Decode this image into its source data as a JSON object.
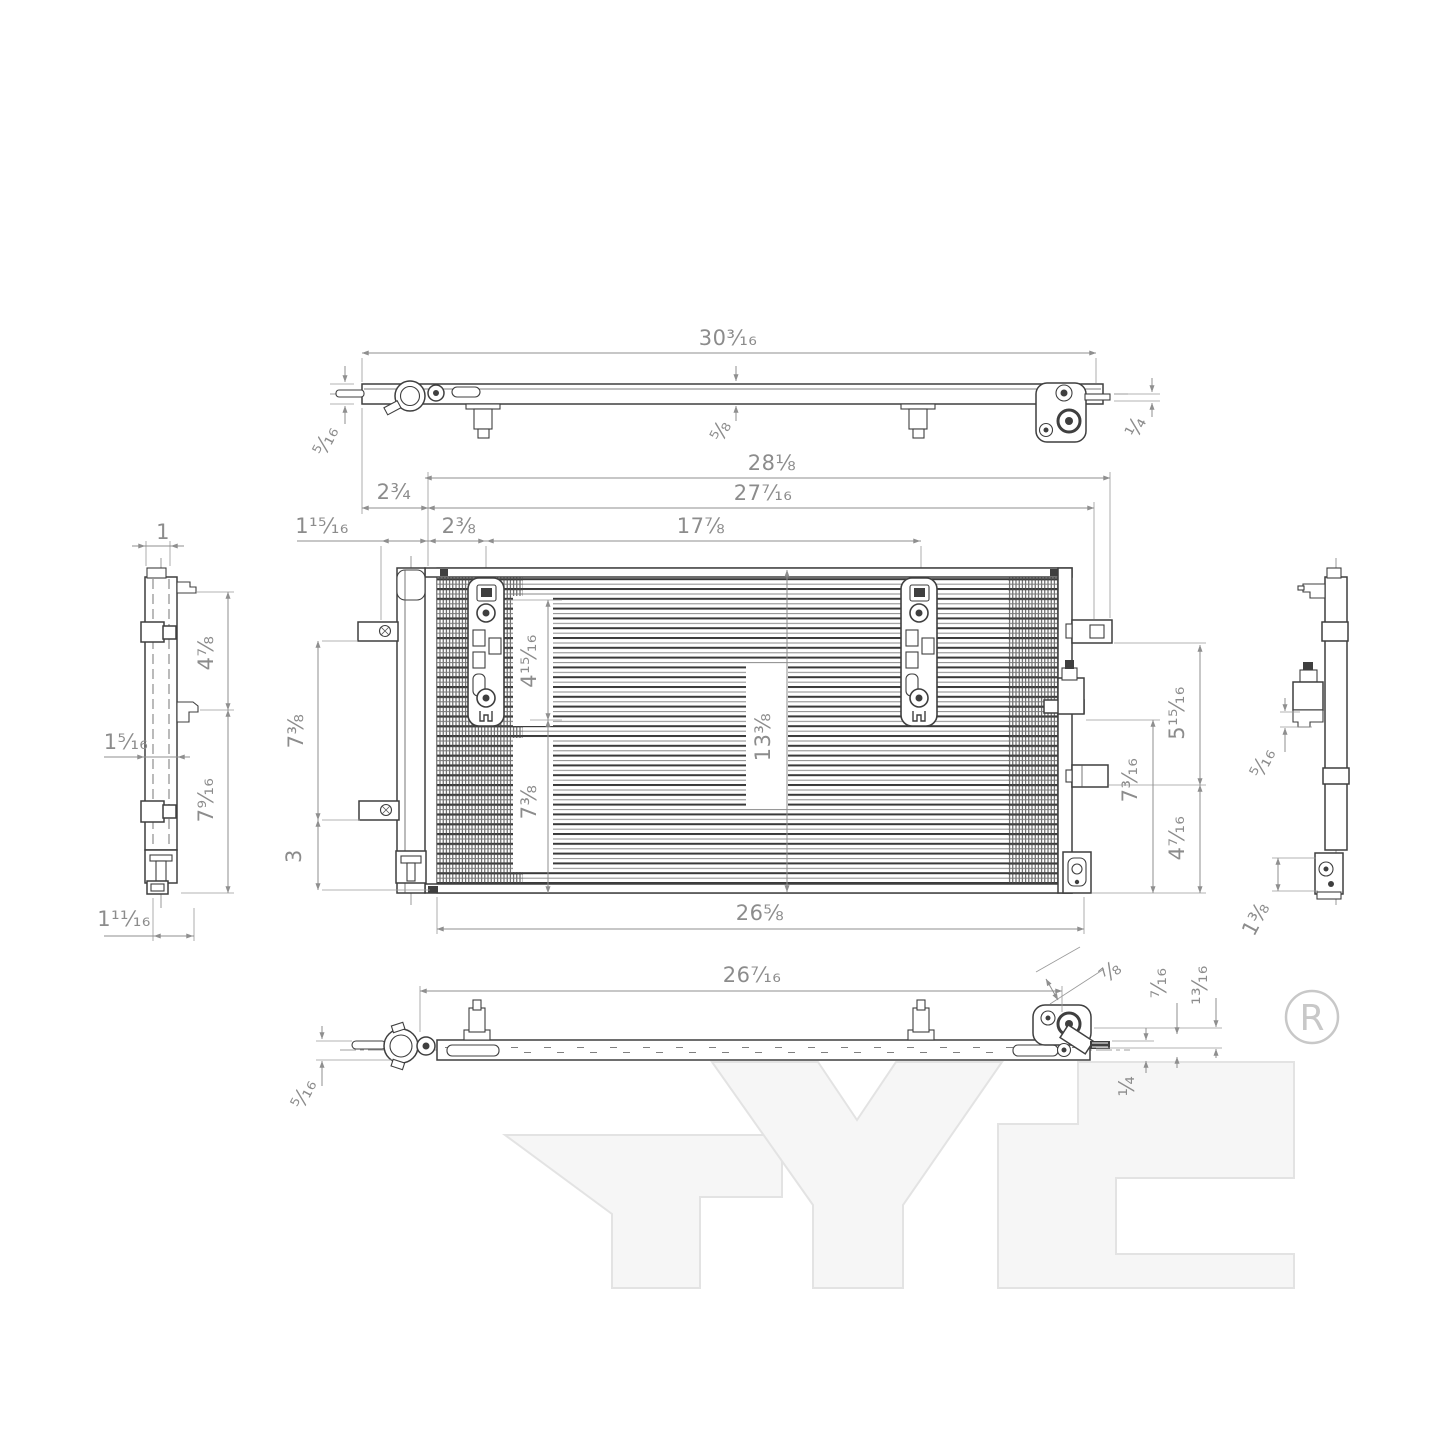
{
  "drawing": {
    "watermark_text": "TYC",
    "registered_symbol": "R",
    "colors": {
      "background": "#ffffff",
      "part_line": "#3f3f3f",
      "dimension_line": "#8f8f8f",
      "dimension_text": "#8c8c8c",
      "watermark_fill": "#f6f6f6",
      "watermark_stroke": "#e3e3e3",
      "registered_gray": "#c8c8c8"
    },
    "dims": {
      "top_width": "30³⁄₁₆",
      "top_left_height": "⁵⁄₁₆",
      "top_mid_height": "⅝",
      "top_right_tab": "¼",
      "fv_overall_width": "28⅛",
      "fv_inner_width": "27⁷⁄₁₆",
      "fv_core_width": "17⅞",
      "fv_left_offset": "2¾",
      "fv_left_inset": "2⅜",
      "fv_left_small": "1¹⁵⁄₁₆",
      "fv_upper_core": "4¹⁵⁄₁₆",
      "fv_mid_height": "13⅜",
      "fv_lower_core": "7⅜",
      "fv_left_span": "7⅜",
      "fv_left_bottom": "3",
      "fv_bottom_width": "26⅝",
      "fv_right_upper": "5¹⁵⁄₁₆",
      "fv_right_mid": "7³⁄₁₆",
      "fv_right_lower": "4⁷⁄₁₆",
      "lv_top_width": "1",
      "lv_upper_height": "4⅞",
      "lv_tab_width": "1⁵⁄₁₆",
      "lv_lower_height": "7⁹⁄₁₆",
      "lv_bottom_width": "1¹¹⁄₁₆",
      "rv_port_gap": "⁵⁄₁₆",
      "rv_bottom_height": "1⅜",
      "bv_width": "26⁷⁄₁₆",
      "bv_bracket_diag": "⅞",
      "bv_bracket_step1": "⁷⁄₁₆",
      "bv_bracket_step2": "¹³⁄₁₆",
      "bv_pin_offset": "¼",
      "bv_left_height": "⁵⁄₁₆"
    }
  }
}
